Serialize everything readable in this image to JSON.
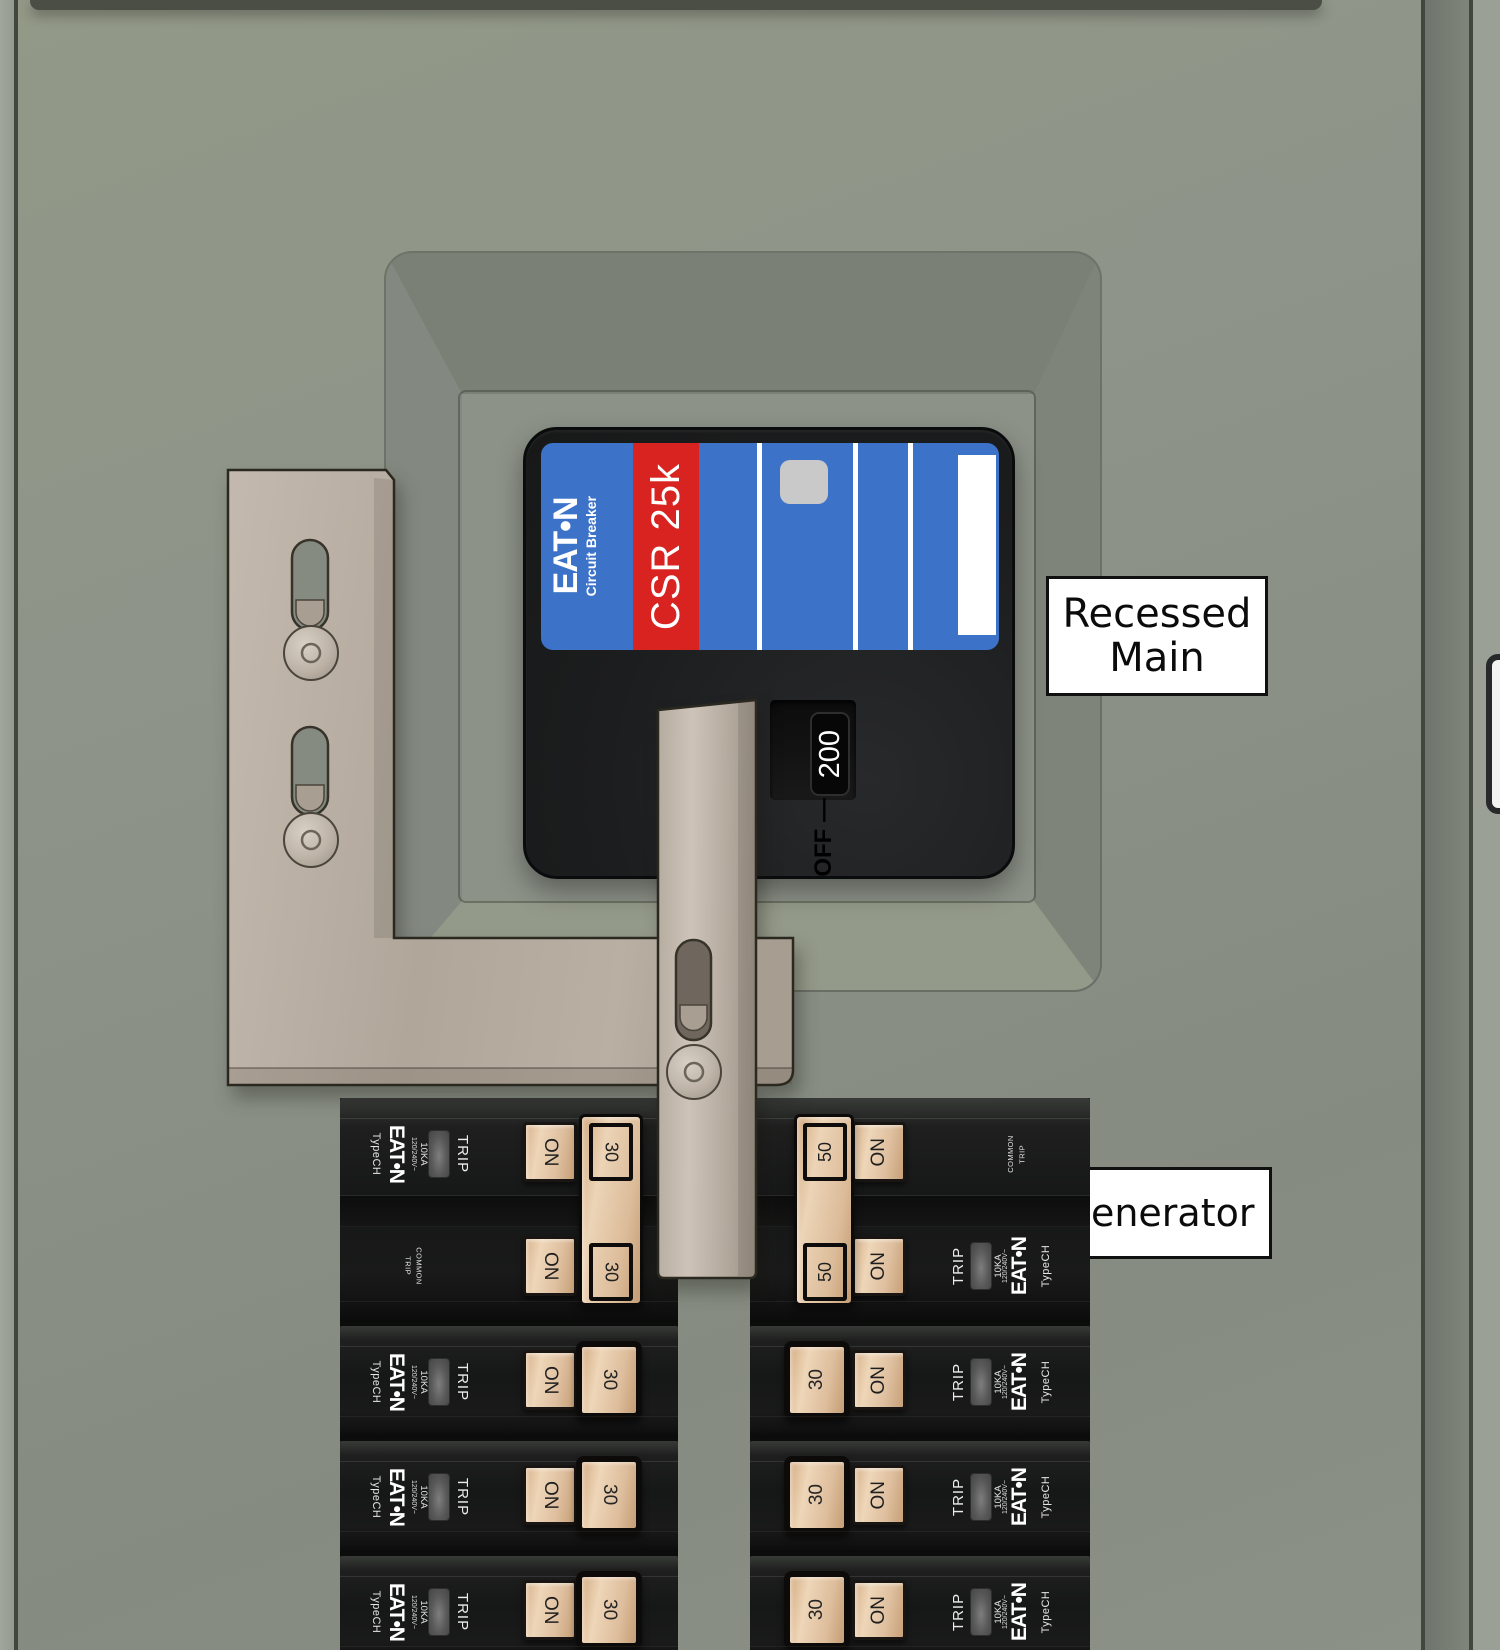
{
  "annotations": {
    "recessed_main": {
      "line1": "Recessed",
      "line2": "Main"
    },
    "generator": "Generator"
  },
  "main_breaker": {
    "brand": "EAT•N",
    "brand_sub": "Circuit Breaker",
    "model": "CSR 25k",
    "rating": "200",
    "off_marking": "OFF —"
  },
  "branch_common": {
    "brand": "EAT•N",
    "type": "TypeCH",
    "voltage": "120/240V~",
    "interrupt_rating": "10KA",
    "trip": "TRIP",
    "on": "ON",
    "common_trip": {
      "line1": "COMMON",
      "line2": "TRIP"
    }
  },
  "left_column": {
    "two_pole_rating": "30",
    "single_ratings": [
      "30",
      "30",
      "30"
    ]
  },
  "right_column": {
    "two_pole_rating": "50",
    "single_ratings": [
      "30",
      "30",
      "30"
    ]
  },
  "colors": {
    "door_gray": "#8d9389",
    "trim_dark": "#4a4e44",
    "breaker_body": "#161717",
    "label_blue": "#3c73c8",
    "stripe_red": "#d92320",
    "toggle_tan": "#e3c39e",
    "bracket_tan": "#b4aa9e",
    "annotation_bg": "#ffffff",
    "annotation_border": "#101010"
  }
}
